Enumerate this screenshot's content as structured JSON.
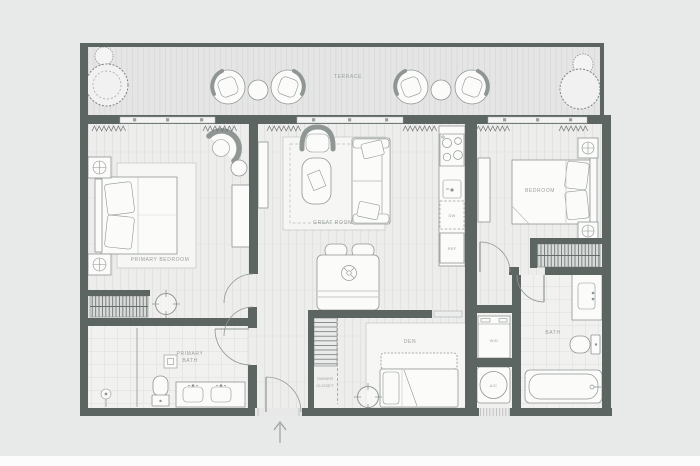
{
  "labels": {
    "terrace": "TERRACE",
    "primary_bedroom": "PRIMARY BEDROOM",
    "great_room": "GREAT ROOM",
    "bedroom": "BEDROOM",
    "den": "DEN",
    "owner_closet_line1": "OWNER",
    "owner_closet_line2": "CLOSET",
    "primary_bath_line1": "PRIMARY",
    "primary_bath_line2": "BATH",
    "bath": "BATH",
    "washer_dryer": "W/D",
    "ac_unit": "A/C",
    "dishwasher": "DW",
    "refrigerator": "REF"
  },
  "colors": {
    "background": "#e8eaea",
    "wall": "#5d6562",
    "interior_floor": "#ededec",
    "terrace_floor": "#e4e5e4",
    "bath_floor": "#f1f1f0",
    "label_text": "#9aa09d",
    "furniture_stroke": "#8f9694",
    "bottom_strip": "#fcfcfc"
  }
}
